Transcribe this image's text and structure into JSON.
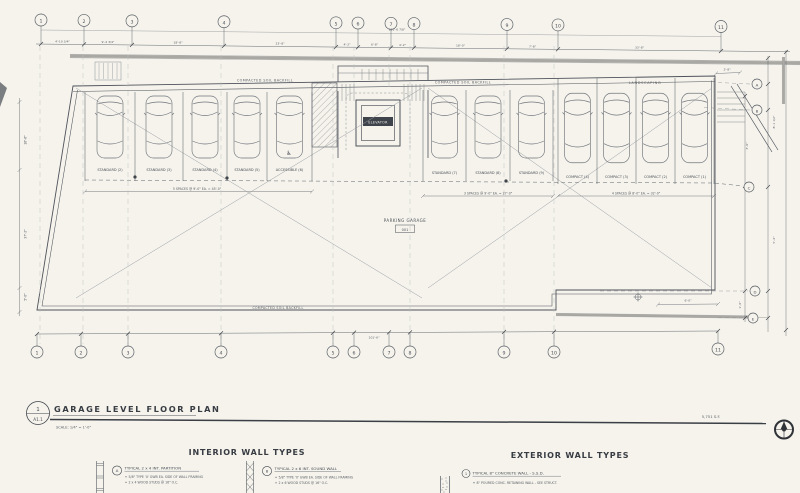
{
  "sheet": {
    "title_ref_top": "1",
    "title_ref_bottom": "A1.1",
    "title": "GARAGE LEVEL FLOOR PLAN",
    "scale": "SCALE: 1/4\" = 1'-0\"",
    "area": "5,751 S.F."
  },
  "grid": {
    "cols": [
      "1",
      "2",
      "3",
      "4",
      "5",
      "6",
      "7",
      "8",
      "9",
      "10",
      "11"
    ],
    "rows": [
      "A",
      "B",
      "C",
      "D",
      "E"
    ]
  },
  "dims": {
    "top": [
      "4'-10 3/4\"",
      "9'-2 3/4\"",
      "18'-8\"",
      "23'-8\"",
      "4'-2\"",
      "6'-8\"",
      "4'-2\"",
      "18'-0\"",
      "7'-8\"",
      "33'-8\""
    ],
    "top_note": "101'-6 7/8\"",
    "left": [
      "16'-6\"",
      "37'-2\"",
      "5'-0\""
    ],
    "right": [
      "2'-8\"",
      "8'-1 1/2\"",
      "3'-0\"",
      "5'-4\"",
      "1'-6\""
    ],
    "bottom": [
      "101'-6\"",
      "6'-0\""
    ]
  },
  "plan": {
    "room_name": "PARKING GARAGE",
    "room_number": "001",
    "elevator_label": "ELEVATOR",
    "landscaping_label": "LANDSCAPING",
    "soil_label_left": "COMPACTED SOIL BACKFILL",
    "soil_label_right": "COMPACTED SOIL BACKFILL",
    "soil_label_bottom": "COMPACTED SOIL BACKFILL",
    "accessible_symbol": "♿",
    "stalls_left": [
      "STANDARD (2)",
      "STANDARD (3)",
      "STANDARD (4)",
      "STANDARD (5)",
      "ACCESSIBLE (6)"
    ],
    "stalls_mid": [
      "STANDARD (7)",
      "STANDARD (8)",
      "STANDARD (9)"
    ],
    "stalls_right": [
      "COMPACT (4)",
      "COMPACT (3)",
      "COMPACT (2)",
      "COMPACT (1)"
    ],
    "spaces_left": "5 SPACES @ 9'-0\" EA. = 45'-0\"",
    "spaces_mid": "3 SPACES @ 9'-0\" EA. = 27'-0\"",
    "spaces_right": "4 SPACES @ 8'-0\" EA. = 32'-0\""
  },
  "wall_types": {
    "interior_heading": "INTERIOR WALL TYPES",
    "exterior_heading": "EXTERIOR WALL TYPES",
    "int_a_tag": "A",
    "int_a_title": "TYPICAL 2 x 4 INT. PARTITION",
    "int_a_note1": "5/8\" TYPE 'X' GWB EA. SIDE OF WALL FRAMING",
    "int_a_note2": "2 x 4 WOOD STUDS @ 16\" O.C.",
    "int_b_tag": "B",
    "int_b_title": "TYPICAL 2 x 6 INT. SOUND WALL",
    "int_b_note1": "5/8\" TYPE 'X' GWB EA. SIDE OF WALL FRAMING",
    "int_b_note2": "2 x 6 WOOD STUDS @ 16\" O.C.",
    "ext_1_tag": "1",
    "ext_1_title": "TYPICAL 8\" CONCRETE WALL - S.S.D.",
    "ext_1_note1": "8\" POURED CONC. RETAINING WALL - SEE STRUCT."
  }
}
